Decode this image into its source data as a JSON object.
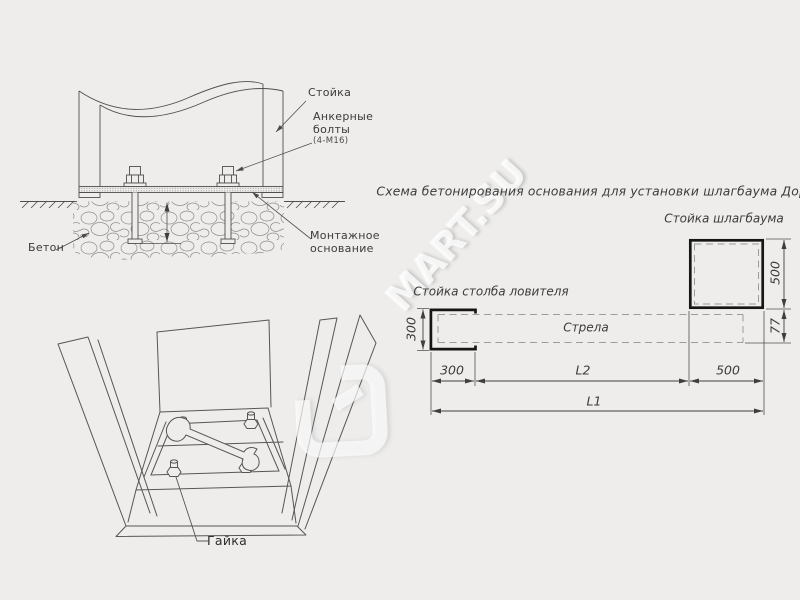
{
  "watermark": {
    "text": "MART.SU"
  },
  "section_view": {
    "labels": {
      "post": "Стойка",
      "anchor_bolts": "Анкерные\nболты",
      "anchor_bolts_spec": "(4-М16)",
      "mounting_base": "Монтажное\nоснование",
      "concrete": "Бетон"
    }
  },
  "perspective_view": {
    "labels": {
      "nut": "Гайка"
    }
  },
  "plan_view": {
    "title": "Схема бетонирования основания для установки шлагбаума ДорХан",
    "labels": {
      "barrier_post": "Стойка шлагбаума",
      "catcher_post": "Стойка столба ловителя",
      "boom": "Стрела"
    },
    "dimensions": {
      "catcher_height": "300",
      "catcher_width": "300",
      "barrier_height": "500",
      "barrier_width": "500",
      "boom_offset": "77",
      "l2": "L2",
      "l1": "L1"
    }
  }
}
